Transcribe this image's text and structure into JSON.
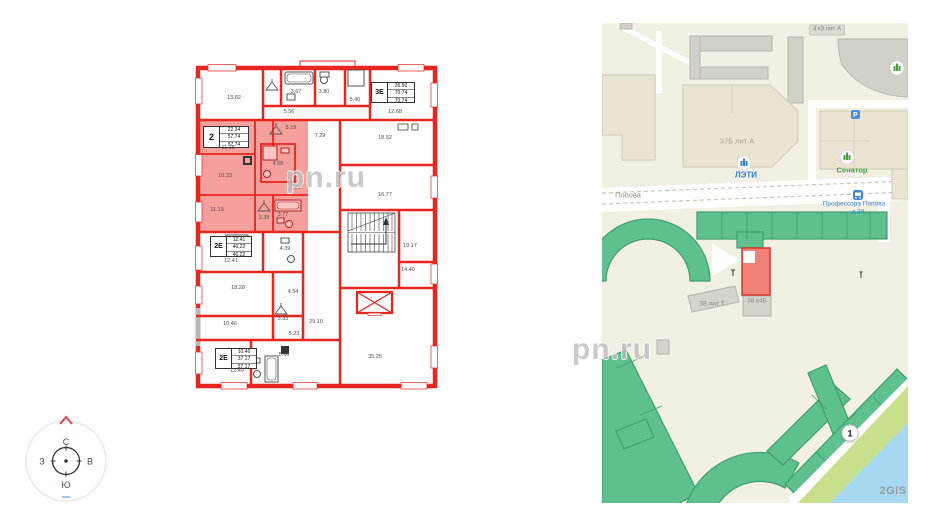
{
  "watermark": {
    "text": "pn.ru"
  },
  "compass": {
    "north": "С",
    "south": "Ю",
    "west": "З",
    "east": "В"
  },
  "plan": {
    "wall_color": "#e8251f",
    "highlight_fill": "#f5a09c",
    "units": [
      {
        "code": "2",
        "rows": [
          "22.34",
          "57.74",
          "57.74"
        ]
      },
      {
        "code": "3Е",
        "rows": [
          "26.50",
          "70.74",
          "70.74"
        ]
      },
      {
        "code": "2Е",
        "rows": [
          "12.41",
          "40.22",
          "40.22"
        ]
      },
      {
        "code": "2Е",
        "rows": [
          "10.46",
          "37.17",
          "37.17"
        ]
      }
    ],
    "rooms": [
      {
        "label": "13.82",
        "x": 41,
        "y": 40
      },
      {
        "label": "3.67",
        "x": 103,
        "y": 34
      },
      {
        "label": "3.80",
        "x": 131,
        "y": 34
      },
      {
        "label": "5.56",
        "x": 96,
        "y": 54
      },
      {
        "label": "5.40",
        "x": 162,
        "y": 42
      },
      {
        "label": "12.68",
        "x": 202,
        "y": 54
      },
      {
        "label": "5.19",
        "x": 98,
        "y": 70
      },
      {
        "label": "11.15",
        "x": 35,
        "y": 90
      },
      {
        "label": "4.58",
        "x": 85,
        "y": 106
      },
      {
        "label": "7.29",
        "x": 127,
        "y": 78
      },
      {
        "label": "18.52",
        "x": 192,
        "y": 80
      },
      {
        "label": "10.33",
        "x": 32,
        "y": 118
      },
      {
        "label": "7.96",
        "x": 102,
        "y": 130
      },
      {
        "label": "16.77",
        "x": 192,
        "y": 137
      },
      {
        "label": "11.19",
        "x": 24,
        "y": 152
      },
      {
        "label": "3.39",
        "x": 71,
        "y": 160
      },
      {
        "label": "3.77",
        "x": 90,
        "y": 157
      },
      {
        "label": "12.41",
        "x": 38,
        "y": 203
      },
      {
        "label": "4.39",
        "x": 92,
        "y": 191
      },
      {
        "label": "18.28",
        "x": 45,
        "y": 230
      },
      {
        "label": "4.54",
        "x": 100,
        "y": 234
      },
      {
        "label": "19.17",
        "x": 217,
        "y": 188
      },
      {
        "label": "14.40",
        "x": 215,
        "y": 212
      },
      {
        "label": "29.10",
        "x": 123,
        "y": 264
      },
      {
        "label": "10.46",
        "x": 37,
        "y": 266
      },
      {
        "label": "3.33",
        "x": 90,
        "y": 261
      },
      {
        "label": "5.23",
        "x": 101,
        "y": 276
      },
      {
        "label": "12.49",
        "x": 44,
        "y": 313
      },
      {
        "label": "5.66",
        "x": 91,
        "y": 297
      },
      {
        "label": "35.25",
        "x": 182,
        "y": 299
      }
    ]
  },
  "map": {
    "colors": {
      "background": "#f2efe3",
      "building_beige": "#e9e5d2",
      "building_gray": "#d3d0c8",
      "building_green": "#5ec08f",
      "building_highlight": "#ef8077",
      "water": "#a6d8f2",
      "park": "#c8e08e",
      "road": "#ffffff"
    },
    "labels": [
      {
        "text": "Попова",
        "x": 26,
        "y": 172,
        "cls": "street"
      },
      {
        "text": "4 к3 лит А",
        "x": 225,
        "y": 7,
        "cls": "chip"
      },
      {
        "text": "37Б лит А",
        "x": 135,
        "y": 118,
        "cls": "bldg"
      },
      {
        "text": "ЛЭТИ",
        "x": 144,
        "y": 152,
        "cls": "poi-blue"
      },
      {
        "text": "Сенатор",
        "x": 250,
        "y": 147,
        "cls": "poi-green"
      },
      {
        "text": "Профессора Попова",
        "x": 252,
        "y": 181,
        "cls": "transit"
      },
      {
        "text": "д 38",
        "x": 256,
        "y": 189,
        "cls": "transit"
      },
      {
        "text": "38 лит Т",
        "x": 110,
        "y": 281,
        "cls": "bldg-sm"
      },
      {
        "text": "38 к4Б",
        "x": 155,
        "y": 278,
        "cls": "bldg-sm"
      },
      {
        "text": "2GIS",
        "x": 291,
        "y": 468,
        "cls": "logo"
      }
    ],
    "marker": {
      "text": "1",
      "x": 248,
      "y": 410
    }
  }
}
